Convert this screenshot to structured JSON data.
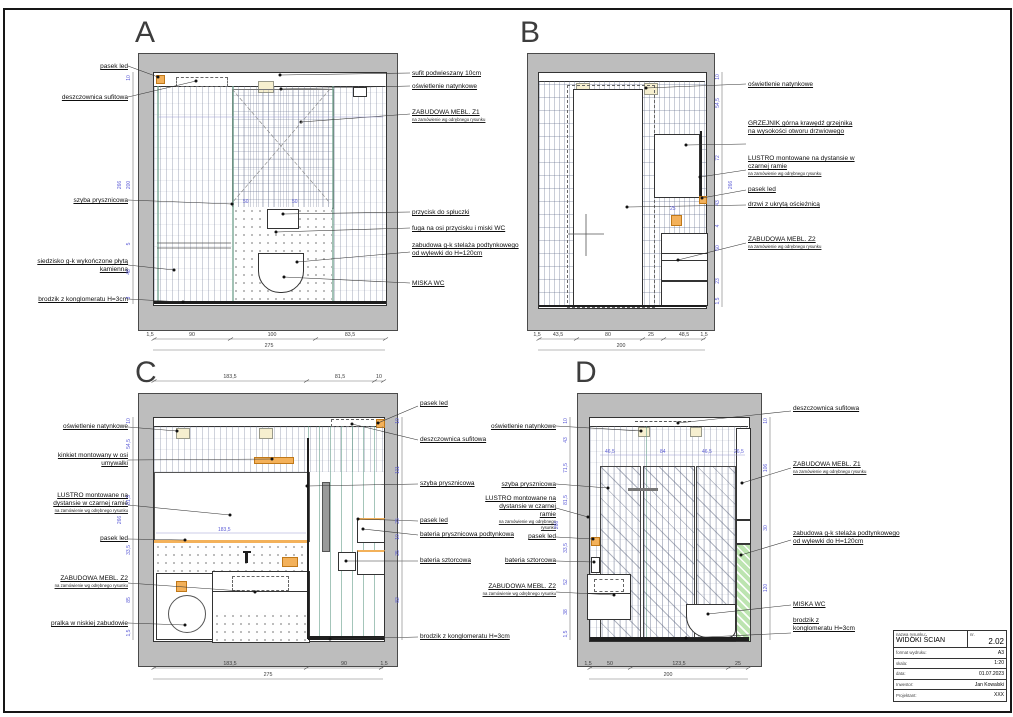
{
  "panels": {
    "A": {
      "letter": "A",
      "left": [
        {
          "text": "pasek led"
        },
        {
          "text": "deszczownica sufitowa"
        },
        {
          "text": "szyba prysznicowa"
        },
        {
          "text": "siedzisko g-k wykończone płytą kamienną"
        },
        {
          "text": "brodzik z konglomeratu H=3cm"
        }
      ],
      "right": [
        {
          "text": "sufit podwieszany 10cm"
        },
        {
          "text": "oświetlenie natynkowe"
        },
        {
          "text": "ZABUDOWA MEBL. Z1",
          "sub": "na zamówienie wg odrębnego rysunku"
        },
        {
          "text": "przycisk do spłuczki"
        },
        {
          "text": "fuga na osi przycisku i miski WC"
        },
        {
          "text": "zabudowa g-k stelaża podtynkowego  od wylewki do H=120cm"
        },
        {
          "text": "MISKA WC"
        }
      ],
      "dims_bottom": [
        "1,5",
        "90",
        "100",
        "83,5"
      ],
      "dim_total": "275",
      "dims_side": [
        "10",
        "200",
        "5",
        "48",
        "3"
      ],
      "dim_height": "266",
      "dims_inner": [
        "50",
        "50"
      ]
    },
    "B": {
      "letter": "B",
      "right": [
        {
          "text": "oświetlenie natynkowe"
        },
        {
          "text": "GRZEJNIK górna krawędź grzejnika na wysokości otworu drzwiowego"
        },
        {
          "text": "LUSTRO montowane na dystansie w czarnej ramie",
          "sub": "na zamówienie wg odrębnego rysunku"
        },
        {
          "text": "pasek led"
        },
        {
          "text": "drzwi z ukrytą ościeżnicą"
        },
        {
          "text": "ZABUDOWA MEBL. Z2",
          "sub": "na zamówienie wg odrębnego rysunku"
        }
      ],
      "dims_bottom": [
        "1,5",
        "43,5",
        "80",
        "25",
        "48,5",
        "1,5"
      ],
      "dim_total": "200",
      "dims_side": [
        "10",
        "54,5",
        "72",
        "43",
        "4",
        "50",
        "23",
        "1,5"
      ],
      "dim_height": "266",
      "dims_inner": [
        "25"
      ]
    },
    "C": {
      "letter": "C",
      "left": [
        {
          "text": "oświetlenie natynkowe"
        },
        {
          "text": "kinkiet montowany w osi umywalki"
        },
        {
          "text": "LUSTRO montowane na dystansie w czarnej ramie",
          "sub": "na zamówienie wg odrębnego rysunku"
        },
        {
          "text": "pasek led"
        },
        {
          "text": "ZABUDOWA MEBL. Z2",
          "sub": "na zamówienie wg odrębnego rysunku"
        },
        {
          "text": "pralka w niskiej zabudowie"
        }
      ],
      "right": [
        {
          "text": "pasek led"
        },
        {
          "text": "deszczownica sufitowa"
        },
        {
          "text": "szyba prysznicowa"
        },
        {
          "text": "pasek led"
        },
        {
          "text": "bateria prysznicowa podtynkowa"
        },
        {
          "text": "bateria sztorcowa"
        },
        {
          "text": "brodzik z konglomeratu H=3cm"
        }
      ],
      "dims_top": [
        "183,5",
        "81,5",
        "10"
      ],
      "dims_bottom": [
        "183,5",
        "90",
        "1,5"
      ],
      "dim_total": "275",
      "dims_side": [
        "10",
        "54,5",
        "81,5",
        "33,5",
        "85",
        "1,5"
      ],
      "dim_height": "266",
      "dims_side_right": [
        "10",
        "111",
        "25",
        "10",
        "25",
        "82"
      ],
      "dims_inner": [
        "183,5"
      ]
    },
    "D": {
      "letter": "D",
      "left": [
        {
          "text": "oświetlenie natynkowe"
        },
        {
          "text": "szyba prysznicowa"
        },
        {
          "text": "LUSTRO montowane na dystansie w czarnej ramie",
          "sub": "na zamówienie wg odrębnego rysunku"
        },
        {
          "text": "pasek led"
        },
        {
          "text": "bateria sztorcowa"
        },
        {
          "text": "ZABUDOWA MEBL. Z2",
          "sub": "na zamówienie wg odrębnego rysunku"
        }
      ],
      "right": [
        {
          "text": "deszczownica sufitowa"
        },
        {
          "text": "ZABUDOWA MEBL. Z1",
          "sub": "na zamówienie wg odrębnego rysunku"
        },
        {
          "text": "zabudowa g-k stelaża podtynkowego  od wylewki do H=120cm"
        },
        {
          "text": "MISKA WC"
        },
        {
          "text": "brodzik z konglomeratu H=3cm"
        }
      ],
      "dims_bottom": [
        "1,5",
        "50",
        "123,5",
        "25"
      ],
      "dim_total": "200",
      "dims_side": [
        "10",
        "43",
        "71,5",
        "81,5",
        "33,5",
        "52",
        "38",
        "1,5"
      ],
      "dim_height": "266",
      "dims_side_right": [
        "10",
        "106",
        "30",
        "120"
      ],
      "dims_inner": [
        "46,5",
        "84",
        "46,5",
        "26,5"
      ]
    }
  },
  "title_block": {
    "name_label": "nazwa rysunku:",
    "name": "WIDOKI ŚCIAN",
    "nr_label": "nr.",
    "nr": "2.02",
    "rows": [
      {
        "label": "format wydruku:",
        "value": "A3"
      },
      {
        "label": "skala:",
        "value": "1:20"
      },
      {
        "label": "data:",
        "value": "01.07.2023"
      },
      {
        "label": "Inwestor:",
        "value": "Jan Kowalski"
      },
      {
        "label": "Projektant:",
        "value": "XXX"
      }
    ]
  },
  "colors": {
    "accent_orange": "#f3b15a",
    "light_fixture": "#f6efcf",
    "green_hatch": "#bce4b0",
    "dim_blue": "#5b5bd6",
    "wall_gray": "#bdbdbd"
  }
}
